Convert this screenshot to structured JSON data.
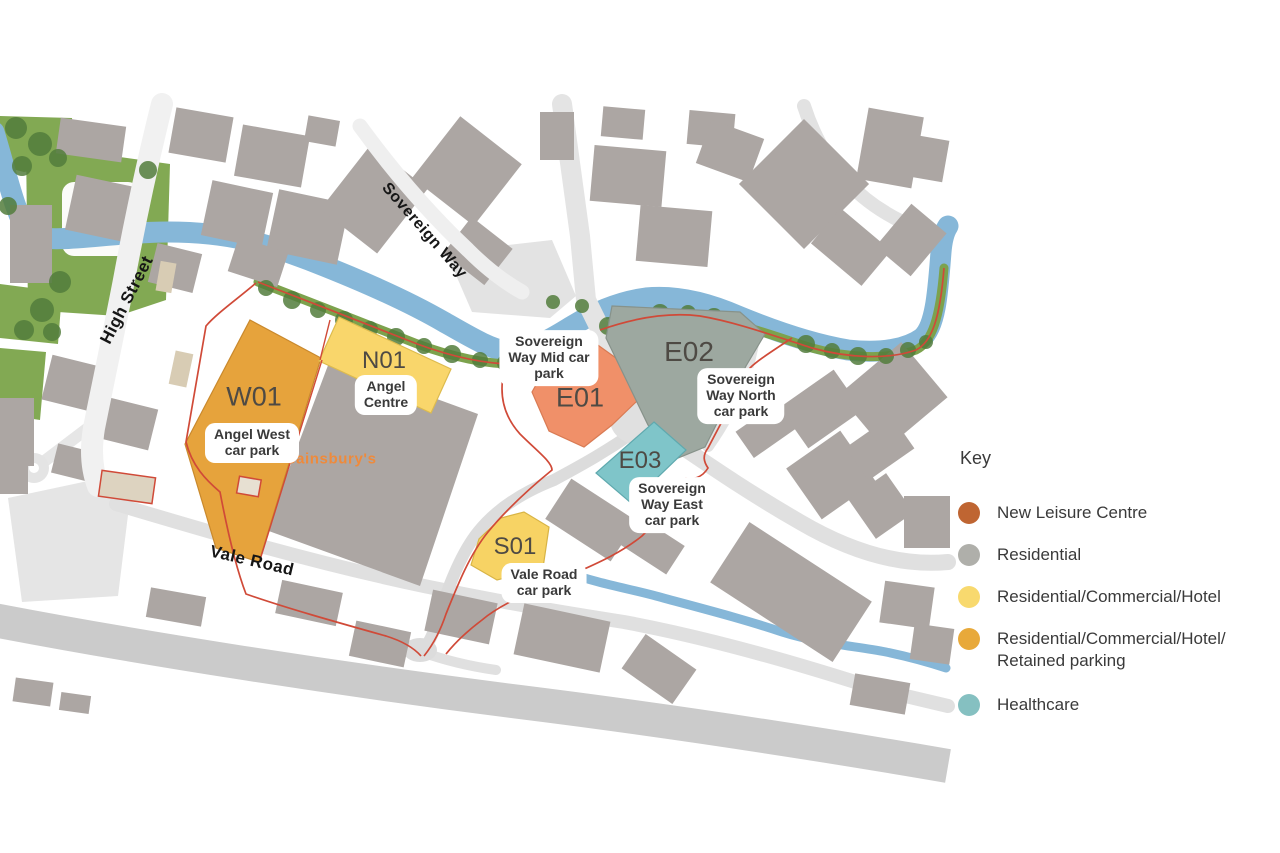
{
  "map": {
    "roads": {
      "high_street": "High Street",
      "sovereign_way": "Sovereign Way",
      "vale_road": "Vale Road"
    },
    "landmark": "Sainsbury's",
    "parcels": [
      {
        "code": "W01",
        "name": "Angel West car park",
        "label_lines": [
          "Angel West",
          "car park"
        ],
        "use": "Residential/Commercial/Hotel/Retained parking",
        "color": "#E6A33C"
      },
      {
        "code": "N01",
        "name": "Angel Centre",
        "label_lines": [
          "Angel",
          "Centre"
        ],
        "use": "Residential/Commercial/Hotel",
        "color": "#F9D66B"
      },
      {
        "code": "E01",
        "name": "Sovereign Way Mid car park",
        "label_lines": [
          "Sovereign",
          "Way Mid car",
          "park"
        ],
        "use": "New Leisure Centre",
        "color": "#F09069"
      },
      {
        "code": "E02",
        "name": "Sovereign Way North car park",
        "label_lines": [
          "Sovereign",
          "Way North",
          "car park"
        ],
        "use": "Residential",
        "color": "#9DA8A0"
      },
      {
        "code": "E03",
        "name": "Sovereign Way East car park",
        "label_lines": [
          "Sovereign",
          "Way East",
          "car park"
        ],
        "use": "Healthcare",
        "color": "#7FC5C9"
      },
      {
        "code": "S01",
        "name": "Vale Road car park",
        "label_lines": [
          "Vale Road",
          "car park"
        ],
        "use": "Residential/Commercial/Hotel",
        "color": "#F7D364"
      }
    ],
    "boundary_color": "#D04A38",
    "river_color": "#86B7D8",
    "green_color": "#82A953"
  },
  "key": {
    "title": "Key",
    "items": [
      {
        "label": "New Leisure Centre",
        "lines": [
          "New Leisure Centre"
        ],
        "color": "#BF6532"
      },
      {
        "label": "Residential",
        "lines": [
          "Residential"
        ],
        "color": "#AFAFAA"
      },
      {
        "label": "Residential/Commercial/Hotel",
        "lines": [
          "Residential/Commercial/Hotel"
        ],
        "color": "#F8D96E"
      },
      {
        "label": "Residential/Commercial/Hotel/Retained parking",
        "lines": [
          "Residential/Commercial/Hotel/",
          "Retained parking"
        ],
        "color": "#E8A93A"
      },
      {
        "label": "Healthcare",
        "lines": [
          "Healthcare"
        ],
        "color": "#85C0C1"
      }
    ]
  }
}
